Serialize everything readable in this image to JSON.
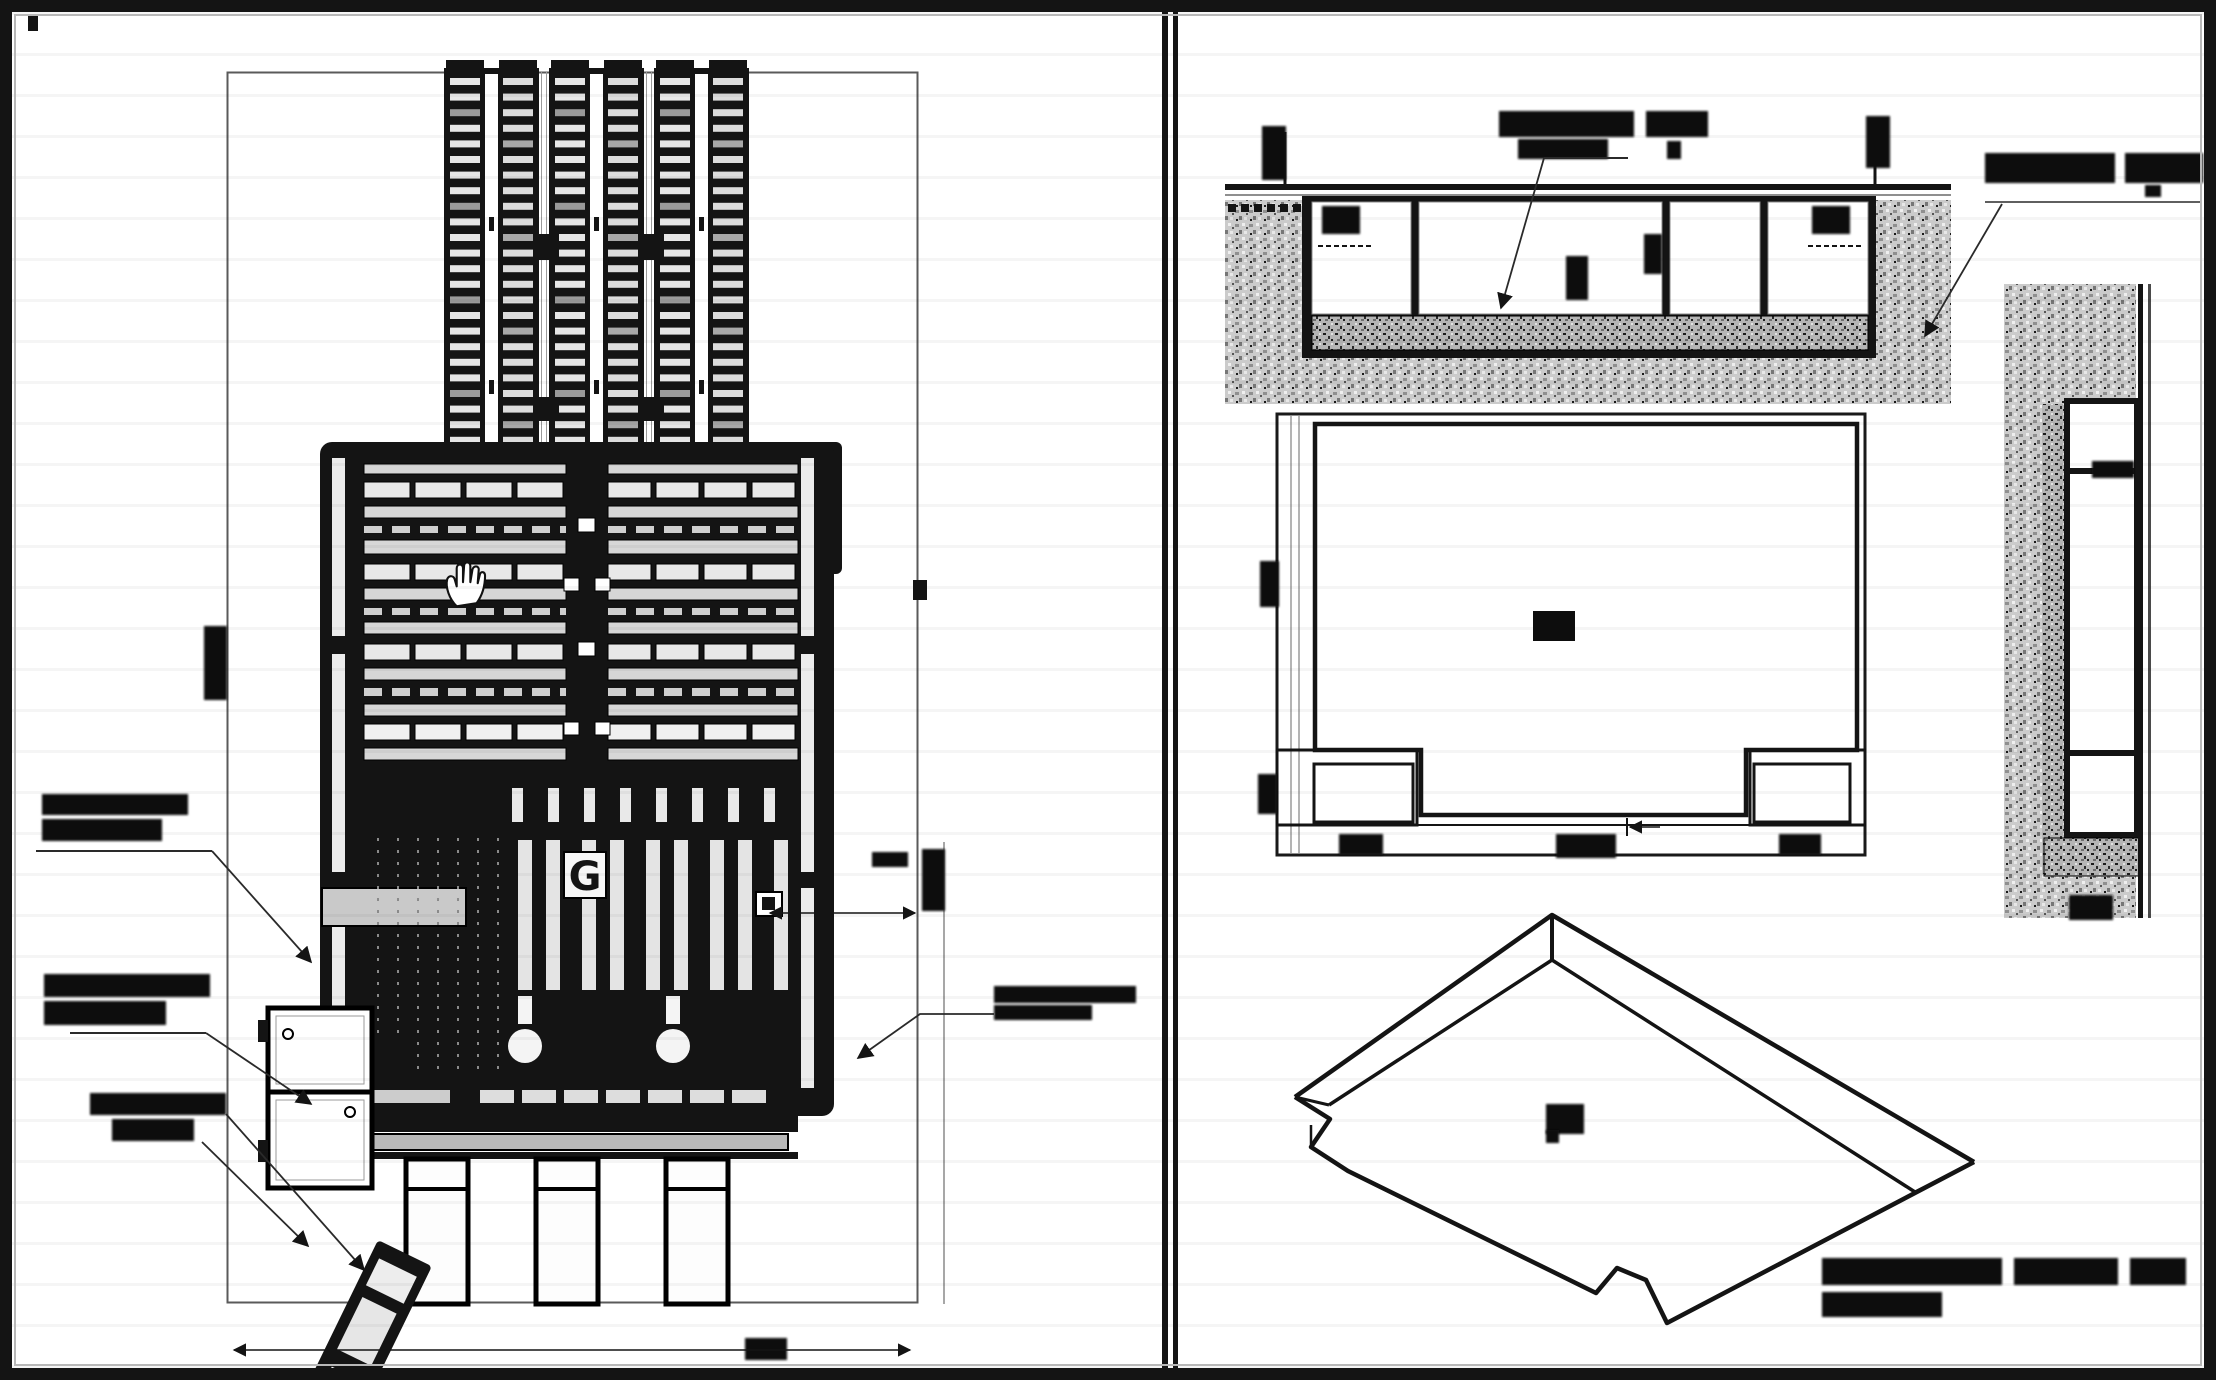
{
  "page": {
    "kind": "scanned engineering drawing sheet",
    "panel_count": 2,
    "ink_color": "#141414",
    "paper_color": "#ffffff",
    "earth_hatch_color": "#cbcbcb",
    "concrete_hatch_color": "#b5b5b5"
  },
  "left_panel": {
    "view_id": "machine-plan-view",
    "track_count": 3,
    "track_rung_rows": 24,
    "leg_count": 3,
    "center_glyph": "G",
    "cursor": "hand-cursor",
    "callouts": [
      {
        "id": "left-callout-1",
        "lines": 2,
        "legible": false
      },
      {
        "id": "left-callout-2",
        "lines": 2,
        "legible": false
      },
      {
        "id": "left-callout-3",
        "lines": 2,
        "legible": false
      },
      {
        "id": "right-callout-1",
        "lines": 2,
        "legible": false
      }
    ],
    "dimension_marks": [
      {
        "id": "left-vertical-dim",
        "legible": false
      },
      {
        "id": "right-horizontal-dim",
        "legible": false
      },
      {
        "id": "right-vertical-dim",
        "legible": false
      },
      {
        "id": "bottom-center-dim",
        "legible": false
      }
    ]
  },
  "right_panel": {
    "views": [
      {
        "id": "section-1-1",
        "cells": 4,
        "title_legible": false,
        "labels": [
          {
            "id": "top-center-callout",
            "legible": false
          },
          {
            "id": "top-right-callout",
            "legible": false
          },
          {
            "id": "left-cell-dim",
            "legible": false
          },
          {
            "id": "right-cell-dim",
            "legible": false
          }
        ]
      },
      {
        "id": "section-2-2",
        "cells": 3,
        "title_legible": false,
        "labels": [
          {
            "id": "top-cell-dim",
            "legible": false
          }
        ]
      },
      {
        "id": "pit-plan",
        "corner_tabs": 2,
        "center_label_legible": false,
        "labels": [
          {
            "id": "bottom-dim-left",
            "legible": false
          },
          {
            "id": "bottom-dim-center",
            "legible": false
          },
          {
            "id": "bottom-dim-right",
            "legible": false
          },
          {
            "id": "left-dim-upper",
            "legible": false
          },
          {
            "id": "left-dim-lower",
            "legible": false
          }
        ]
      },
      {
        "id": "pit-isometric",
        "caption_lines": 2,
        "caption_legible": false,
        "center_label_legible": false
      }
    ]
  }
}
